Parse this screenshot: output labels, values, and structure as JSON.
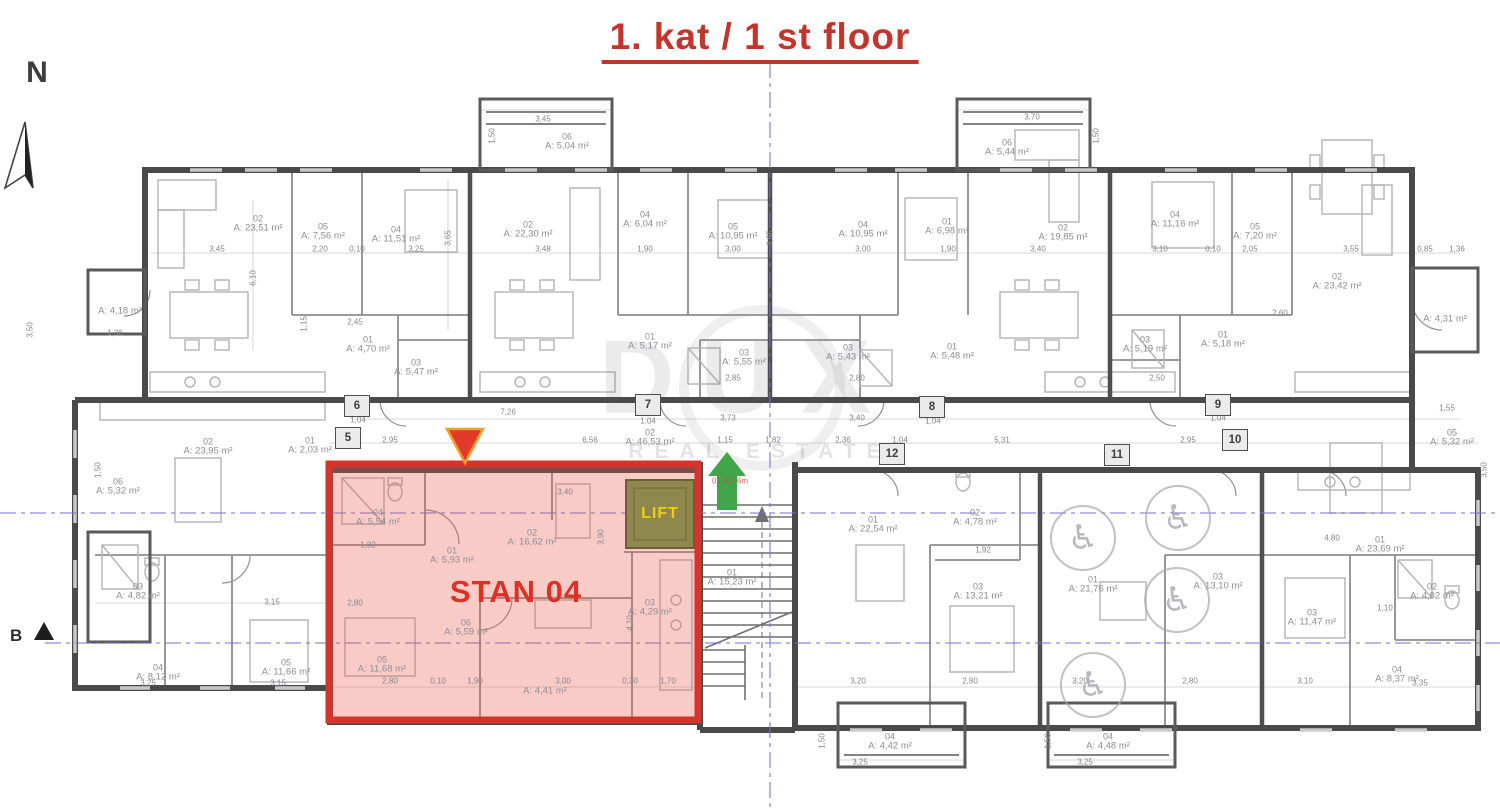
{
  "title": "1. kat / 1 st floor",
  "north": "N",
  "section": "B",
  "watermark": {
    "name": "DUX",
    "tag": "REAL ESTATE"
  },
  "highlight": {
    "label": "STAN 04",
    "lift": "LIFT",
    "stair_note": "02 3,2-6m"
  },
  "colors": {
    "accent_red": "#d6332a",
    "overlay_fill": "rgba(233,84,71,0.30)",
    "lift_fill": "#8e884f",
    "lift_text": "#f1cd0e",
    "green_arrow": "#3fa74a",
    "blue_axis": "#7070d8"
  },
  "icons": {
    "wheelchair": "♿"
  },
  "grid_bubbles": [
    {
      "n": "5",
      "x": 348,
      "y": 438
    },
    {
      "n": "6",
      "x": 357,
      "y": 406
    },
    {
      "n": "7",
      "x": 648,
      "y": 405
    },
    {
      "n": "8",
      "x": 932,
      "y": 407
    },
    {
      "n": "9",
      "x": 1218,
      "y": 405
    },
    {
      "n": "10",
      "x": 1235,
      "y": 440
    },
    {
      "n": "11",
      "x": 1117,
      "y": 455
    },
    {
      "n": "12",
      "x": 892,
      "y": 454
    }
  ],
  "rooms": [
    {
      "id": "02",
      "area": "A: 23,51 m²",
      "x": 258,
      "y": 224
    },
    {
      "id": "05",
      "area": "A: 7,56 m²",
      "x": 323,
      "y": 232
    },
    {
      "id": "04",
      "area": "A: 11,51 m²",
      "x": 396,
      "y": 235
    },
    {
      "id": "01",
      "area": "A: 4,70 m²",
      "x": 368,
      "y": 345
    },
    {
      "id": "03",
      "area": "A: 5,47 m²",
      "x": 416,
      "y": 368
    },
    {
      "id": "06",
      "area": "A: 5,04 m²",
      "x": 567,
      "y": 142
    },
    {
      "id": "02",
      "area": "A: 22,30 m²",
      "x": 528,
      "y": 230
    },
    {
      "id": "04",
      "area": "A: 6,04 m²",
      "x": 645,
      "y": 220
    },
    {
      "id": "05",
      "area": "A: 10,95 m²",
      "x": 733,
      "y": 232
    },
    {
      "id": "01",
      "area": "A: 5,17 m²",
      "x": 650,
      "y": 342
    },
    {
      "id": "03",
      "area": "A: 5,55 m²",
      "x": 744,
      "y": 358
    },
    {
      "id": "06",
      "area": "A: 5,44 m²",
      "x": 1007,
      "y": 148
    },
    {
      "id": "04",
      "area": "A: 10,95 m²",
      "x": 863,
      "y": 230
    },
    {
      "id": "01",
      "area": "A: 6,98 m²",
      "x": 947,
      "y": 227
    },
    {
      "id": "02",
      "area": "A: 19,85 m²",
      "x": 1063,
      "y": 233
    },
    {
      "id": "03",
      "area": "A: 5,43 m²",
      "x": 848,
      "y": 353
    },
    {
      "id": "01",
      "area": "A: 5,48 m²",
      "x": 952,
      "y": 352
    },
    {
      "id": "04",
      "area": "A: 11,16 m²",
      "x": 1175,
      "y": 220
    },
    {
      "id": "05",
      "area": "A: 7,20 m²",
      "x": 1255,
      "y": 232
    },
    {
      "id": "02",
      "area": "A: 23,42 m²",
      "x": 1337,
      "y": 282
    },
    {
      "id": "01",
      "area": "A: 5,18 m²",
      "x": 1223,
      "y": 340
    },
    {
      "id": "03",
      "area": "A: 5,19 m²",
      "x": 1145,
      "y": 345
    },
    {
      "id": "",
      "area": "A: 4,31 m²",
      "x": 1445,
      "y": 320
    },
    {
      "id": "",
      "area": "A: 4,18 m²",
      "x": 120,
      "y": 312
    },
    {
      "id": "02",
      "area": "A: 46,53 m²",
      "x": 650,
      "y": 438
    },
    {
      "id": "02",
      "area": "A: 23,95 m²",
      "x": 208,
      "y": 447
    },
    {
      "id": "06",
      "area": "A: 5,32 m²",
      "x": 118,
      "y": 487
    },
    {
      "id": "03",
      "area": "A: 4,82 m²",
      "x": 138,
      "y": 592
    },
    {
      "id": "04",
      "area": "A: 8,12 m²",
      "x": 158,
      "y": 673
    },
    {
      "id": "05",
      "area": "A: 11,66 m²",
      "x": 286,
      "y": 668
    },
    {
      "id": "01",
      "area": "A: 2,03 m²",
      "x": 310,
      "y": 446
    },
    {
      "id": "04",
      "area": "A: 5,54 m²",
      "x": 378,
      "y": 518
    },
    {
      "id": "01",
      "area": "A: 5,93 m²",
      "x": 452,
      "y": 556
    },
    {
      "id": "02",
      "area": "A: 16,62 m²",
      "x": 532,
      "y": 538
    },
    {
      "id": "06",
      "area": "A: 5,59 m²",
      "x": 466,
      "y": 628
    },
    {
      "id": "05",
      "area": "A: 11,68 m²",
      "x": 382,
      "y": 665
    },
    {
      "id": "03",
      "area": "A: 4,29 m²",
      "x": 650,
      "y": 608
    },
    {
      "id": "",
      "area": "A: 4,41 m²",
      "x": 545,
      "y": 692
    },
    {
      "id": "01",
      "area": "A: 15,23 m²",
      "x": 732,
      "y": 578
    },
    {
      "id": "01",
      "area": "A: 22,54 m²",
      "x": 873,
      "y": 525
    },
    {
      "id": "02",
      "area": "A: 4,78 m²",
      "x": 975,
      "y": 518
    },
    {
      "id": "03",
      "area": "A: 13,21 m²",
      "x": 978,
      "y": 592
    },
    {
      "id": "01",
      "area": "A: 21,76 m²",
      "x": 1093,
      "y": 585
    },
    {
      "id": "03",
      "area": "A: 13,10 m²",
      "x": 1218,
      "y": 582
    },
    {
      "id": "01",
      "area": "A: 23,69 m²",
      "x": 1380,
      "y": 545
    },
    {
      "id": "02",
      "area": "A: 4,82 m²",
      "x": 1432,
      "y": 592
    },
    {
      "id": "03",
      "area": "A: 11,47 m²",
      "x": 1312,
      "y": 618
    },
    {
      "id": "04",
      "area": "A: 8,37 m²",
      "x": 1397,
      "y": 675
    },
    {
      "id": "04",
      "area": "A: 4,42 m²",
      "x": 890,
      "y": 742
    },
    {
      "id": "04",
      "area": "A: 4,48 m²",
      "x": 1108,
      "y": 742
    },
    {
      "id": "05",
      "area": "A: 5,32 m²",
      "x": 1452,
      "y": 438
    }
  ],
  "dims": [
    {
      "t": "3,45",
      "x": 217,
      "y": 249
    },
    {
      "t": "2,20",
      "x": 320,
      "y": 249
    },
    {
      "t": "0,10",
      "x": 357,
      "y": 249
    },
    {
      "t": "3,25",
      "x": 416,
      "y": 249
    },
    {
      "t": "3,65",
      "x": 448,
      "y": 238,
      "r": 1
    },
    {
      "t": "3,48",
      "x": 543,
      "y": 249
    },
    {
      "t": "1,90",
      "x": 645,
      "y": 249
    },
    {
      "t": "3,00",
      "x": 733,
      "y": 249
    },
    {
      "t": "3,65",
      "x": 770,
      "y": 238,
      "r": 1
    },
    {
      "t": "3,00",
      "x": 863,
      "y": 249
    },
    {
      "t": "1,90",
      "x": 948,
      "y": 249
    },
    {
      "t": "3,40",
      "x": 1038,
      "y": 249
    },
    {
      "t": "3,10",
      "x": 1160,
      "y": 249
    },
    {
      "t": "0,10",
      "x": 1213,
      "y": 249
    },
    {
      "t": "2,05",
      "x": 1250,
      "y": 249
    },
    {
      "t": "3,55",
      "x": 1351,
      "y": 249
    },
    {
      "t": "0,85",
      "x": 1425,
      "y": 249
    },
    {
      "t": "1,36",
      "x": 1457,
      "y": 249
    },
    {
      "t": "3,45",
      "x": 543,
      "y": 119
    },
    {
      "t": "3,70",
      "x": 1032,
      "y": 117
    },
    {
      "t": "1,50",
      "x": 492,
      "y": 136,
      "r": 1
    },
    {
      "t": "1,50",
      "x": 1096,
      "y": 136,
      "r": 1
    },
    {
      "t": "1,36",
      "x": 115,
      "y": 333
    },
    {
      "t": "2,45",
      "x": 355,
      "y": 322
    },
    {
      "t": "1,15",
      "x": 304,
      "y": 324,
      "r": 1
    },
    {
      "t": "6,10",
      "x": 253,
      "y": 278,
      "r": 1
    },
    {
      "t": "2,85",
      "x": 733,
      "y": 378
    },
    {
      "t": "2,80",
      "x": 857,
      "y": 378
    },
    {
      "t": "2,50",
      "x": 1157,
      "y": 378
    },
    {
      "t": "2,60",
      "x": 1280,
      "y": 313
    },
    {
      "t": "7,26",
      "x": 508,
      "y": 412
    },
    {
      "t": "1,04",
      "x": 358,
      "y": 420
    },
    {
      "t": "2,95",
      "x": 390,
      "y": 440
    },
    {
      "t": "6,56",
      "x": 590,
      "y": 440
    },
    {
      "t": "1,04",
      "x": 648,
      "y": 421
    },
    {
      "t": "3,73",
      "x": 728,
      "y": 418
    },
    {
      "t": "3,40",
      "x": 857,
      "y": 418
    },
    {
      "t": "1,04",
      "x": 933,
      "y": 421
    },
    {
      "t": "1,15",
      "x": 725,
      "y": 440
    },
    {
      "t": "1,82",
      "x": 773,
      "y": 440
    },
    {
      "t": "2,36",
      "x": 843,
      "y": 440
    },
    {
      "t": "1,04",
      "x": 900,
      "y": 440
    },
    {
      "t": "5,31",
      "x": 1002,
      "y": 440
    },
    {
      "t": "1,04",
      "x": 1218,
      "y": 418
    },
    {
      "t": "2,95",
      "x": 1188,
      "y": 440
    },
    {
      "t": "1,55",
      "x": 1447,
      "y": 408
    },
    {
      "t": "3,40",
      "x": 565,
      "y": 492
    },
    {
      "t": "1,82",
      "x": 368,
      "y": 545
    },
    {
      "t": "3,90",
      "x": 601,
      "y": 537,
      "r": 1
    },
    {
      "t": "4,10",
      "x": 630,
      "y": 623,
      "r": 1
    },
    {
      "t": "2,80",
      "x": 355,
      "y": 603
    },
    {
      "t": "3,15",
      "x": 272,
      "y": 602
    },
    {
      "t": "2,80",
      "x": 390,
      "y": 681
    },
    {
      "t": "0,10",
      "x": 438,
      "y": 681
    },
    {
      "t": "1,90",
      "x": 475,
      "y": 681
    },
    {
      "t": "3,00",
      "x": 563,
      "y": 681
    },
    {
      "t": "0,30",
      "x": 630,
      "y": 681
    },
    {
      "t": "1,70",
      "x": 668,
      "y": 681
    },
    {
      "t": "3,25",
      "x": 148,
      "y": 683
    },
    {
      "t": "3,15",
      "x": 278,
      "y": 683
    },
    {
      "t": "3,20",
      "x": 858,
      "y": 681
    },
    {
      "t": "2,80",
      "x": 970,
      "y": 681
    },
    {
      "t": "3,20",
      "x": 1080,
      "y": 681
    },
    {
      "t": "1,92",
      "x": 983,
      "y": 550
    },
    {
      "t": "4,80",
      "x": 1332,
      "y": 538
    },
    {
      "t": "2,80",
      "x": 1190,
      "y": 681
    },
    {
      "t": "3,10",
      "x": 1305,
      "y": 681
    },
    {
      "t": "3,35",
      "x": 1420,
      "y": 683
    },
    {
      "t": "1,10",
      "x": 1385,
      "y": 608
    },
    {
      "t": "3,25",
      "x": 860,
      "y": 762
    },
    {
      "t": "3,25",
      "x": 1085,
      "y": 762
    },
    {
      "t": "1,50",
      "x": 822,
      "y": 741,
      "r": 1
    },
    {
      "t": "1,50",
      "x": 1048,
      "y": 741,
      "r": 1
    },
    {
      "t": "1,50",
      "x": 98,
      "y": 470,
      "r": 1
    },
    {
      "t": "3,50",
      "x": 30,
      "y": 330,
      "r": 1
    },
    {
      "t": "3,50",
      "x": 1484,
      "y": 470,
      "r": 1
    }
  ],
  "wheelchair_positions": [
    [
      1083,
      538
    ],
    [
      1093,
      685
    ],
    [
      1178,
      518
    ],
    [
      1177,
      600
    ]
  ]
}
